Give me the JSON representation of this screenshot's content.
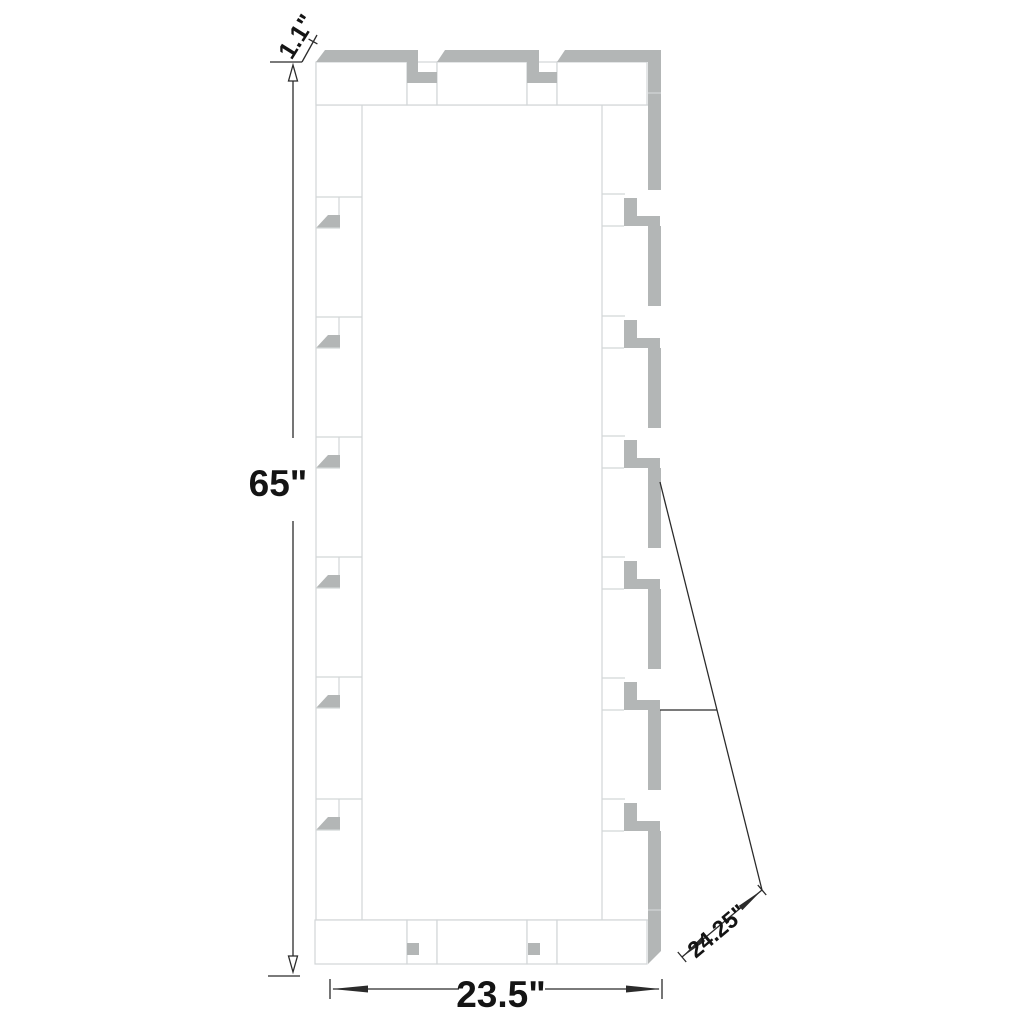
{
  "diagram": {
    "labels": {
      "frame_thickness": "1.1\"",
      "overall_height": "65\"",
      "overall_width": "23.5\"",
      "panel_length": "24.25\""
    },
    "colors": {
      "panel_gray": "#b3b6b6",
      "outline": "#d2d6d7",
      "dimension": "#2b2b2b",
      "background": "#ffffff"
    }
  }
}
